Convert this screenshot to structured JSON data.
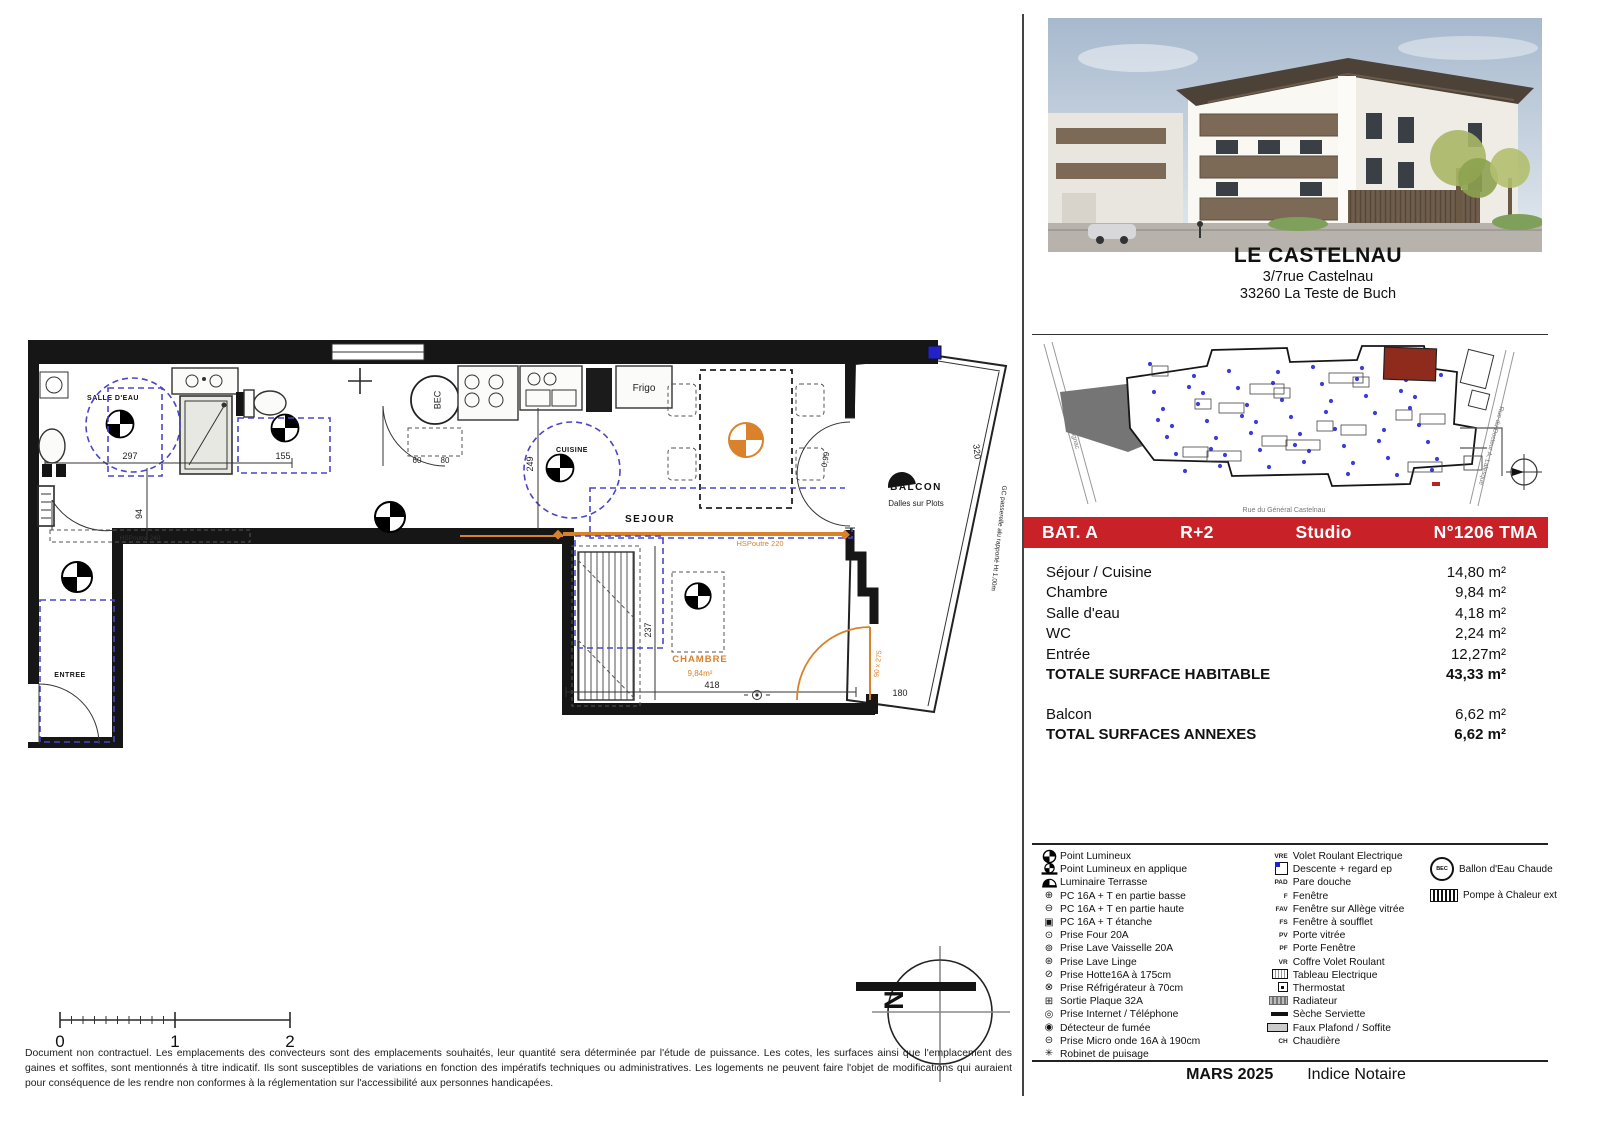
{
  "project": {
    "name": "LE CASTELNAU",
    "address1": "3/7rue Castelnau",
    "address2": "33260 La Teste de Buch"
  },
  "site_map": {
    "street_left": "Rue Pierre Dignac",
    "street_bottom": "Rue du Général Castelnau",
    "street_right": "Rue du Docteur A. Lalesque"
  },
  "banner": {
    "bat": "BAT. A",
    "floor": "R+2",
    "type": "Studio",
    "unit": "N°1206 TMA"
  },
  "colors": {
    "banner_red": "#c92128",
    "unit_highlight": "#8e2b1c",
    "plan_orange": "#d9822b",
    "plan_blue": "#4947c8",
    "descente_blue": "#2222cc"
  },
  "surfaces": {
    "rows": [
      {
        "label": "Séjour / Cuisine",
        "value": "14,80 m²"
      },
      {
        "label": "Chambre",
        "value": "9,84 m²"
      },
      {
        "label": "Salle d'eau",
        "value": "4,18 m²"
      },
      {
        "label": "WC",
        "value": "2,24 m²"
      },
      {
        "label": "Entrée",
        "value": "12,27m²"
      }
    ],
    "total": {
      "label": "TOTALE SURFACE HABITABLE",
      "value": "43,33 m²"
    },
    "annexes": [
      {
        "label": "Balcon",
        "value": "6,62 m²"
      }
    ],
    "annex_total": {
      "label": "TOTAL SURFACES ANNEXES",
      "value": "6,62 m²"
    }
  },
  "legend": {
    "col1": [
      {
        "icon": "point-lumineux-icon",
        "label": "Point Lumineux"
      },
      {
        "icon": "point-lumineux-applique-icon",
        "label": "Point Lumineux en applique"
      },
      {
        "icon": "luminaire-terrasse-icon",
        "label": "Luminaire Terrasse"
      },
      {
        "icon": "pc-basse-icon",
        "label": "PC 16A + T en partie basse"
      },
      {
        "icon": "pc-haute-icon",
        "label": "PC 16A + T en partie haute"
      },
      {
        "icon": "pc-etanche-icon",
        "label": "PC 16A + T étanche"
      },
      {
        "icon": "prise-four-icon",
        "label": "Prise Four 20A"
      },
      {
        "icon": "prise-lv-icon",
        "label": "Prise Lave Vaisselle 20A"
      },
      {
        "icon": "prise-ll-icon",
        "label": "Prise Lave Linge"
      },
      {
        "icon": "prise-hotte-icon",
        "label": "Prise Hotte16A à 175cm"
      },
      {
        "icon": "prise-frigo-icon",
        "label": "Prise Réfrigérateur à 70cm"
      },
      {
        "icon": "sortie-plaque-icon",
        "label": "Sortie Plaque 32A"
      },
      {
        "icon": "prise-internet-icon",
        "label": "Prise Internet / Téléphone"
      },
      {
        "icon": "detecteur-fumee-icon",
        "label": "Détecteur de fumée"
      },
      {
        "icon": "prise-micro-onde-icon",
        "label": "Prise Micro onde 16A à 190cm"
      },
      {
        "icon": "robinet-puisage-icon",
        "label": "Robinet de puisage"
      }
    ],
    "col2": [
      {
        "abbr": "VRE",
        "label": "Volet Roulant Electrique"
      },
      {
        "icon": "descente-ep-icon",
        "label": "Descente + regard ep"
      },
      {
        "abbr": "PAD",
        "label": "Pare douche"
      },
      {
        "abbr": "F",
        "label": "Fenêtre"
      },
      {
        "abbr": "FAV",
        "label": "Fenêtre sur Allège vitrée"
      },
      {
        "abbr": "FS",
        "label": "Fenêtre à soufflet"
      },
      {
        "abbr": "PV",
        "label": "Porte vitrée"
      },
      {
        "abbr": "PF",
        "label": "Porte Fenêtre"
      },
      {
        "abbr": "VR",
        "label": "Coffre Volet Roulant"
      },
      {
        "icon": "tableau-electrique-icon",
        "label": "Tableau Electrique"
      },
      {
        "icon": "thermostat-icon",
        "label": "Thermostat"
      },
      {
        "icon": "radiateur-icon",
        "label": "Radiateur"
      },
      {
        "icon": "seche-serviette-icon",
        "label": "Sèche Serviette"
      },
      {
        "icon": "faux-plafond-icon",
        "label": "Faux Plafond / Soffite"
      },
      {
        "abbr": "CH",
        "label": "Chaudière"
      }
    ],
    "col3": [
      {
        "icon": "bec-icon",
        "badge": "BEC",
        "label": "Ballon d'Eau Chaude"
      },
      {
        "icon": "pac-icon",
        "badge": "",
        "label": "Pompe à Chaleur ext"
      }
    ]
  },
  "footer": {
    "date": "MARS 2025",
    "index": "Indice Notaire"
  },
  "plan": {
    "labels": {
      "salle_deau": "SALLE D'EAU",
      "cuisine": "CUISINE",
      "sejour": "SEJOUR",
      "entree": "ENTREE",
      "chambre": "CHAMBRE",
      "chambre_area": "9,84m²",
      "balcon": "BALCON",
      "balcon_note": "Dalles sur Plots",
      "frigo": "Frigo",
      "bec": "BEC"
    },
    "dims": {
      "a": "297",
      "b": "155",
      "c": "94",
      "d": "249",
      "e": "237",
      "f": "418",
      "g": "320",
      "h": "180",
      "i": "0,99",
      "j": "60",
      "k": "80",
      "hsp240": "HSPoutre 240",
      "hsp220": "HSPoutre 220",
      "gc": "GC passerelle alu rapporté Ht 1,00m",
      "door": "90 x 275"
    },
    "scale": {
      "t0": "0",
      "t1": "1",
      "t2": "2"
    },
    "compass_n": "N"
  },
  "disclaimer": "Document non contractuel. Les emplacements des convecteurs sont des emplacements souhaités, leur quantité sera déterminée par l'étude de puissance. Les cotes, les surfaces ainsi que l'emplacement des gaines et soffites, sont mentionnés à titre indicatif. Ils sont susceptibles de variations en fonction des impératifs techniques ou administratives. Les logements ne peuvent faire l'objet de modifications qui auraient pour conséquence de les rendre non conformes à la réglementation sur l'accessibilité aux personnes handicapées."
}
